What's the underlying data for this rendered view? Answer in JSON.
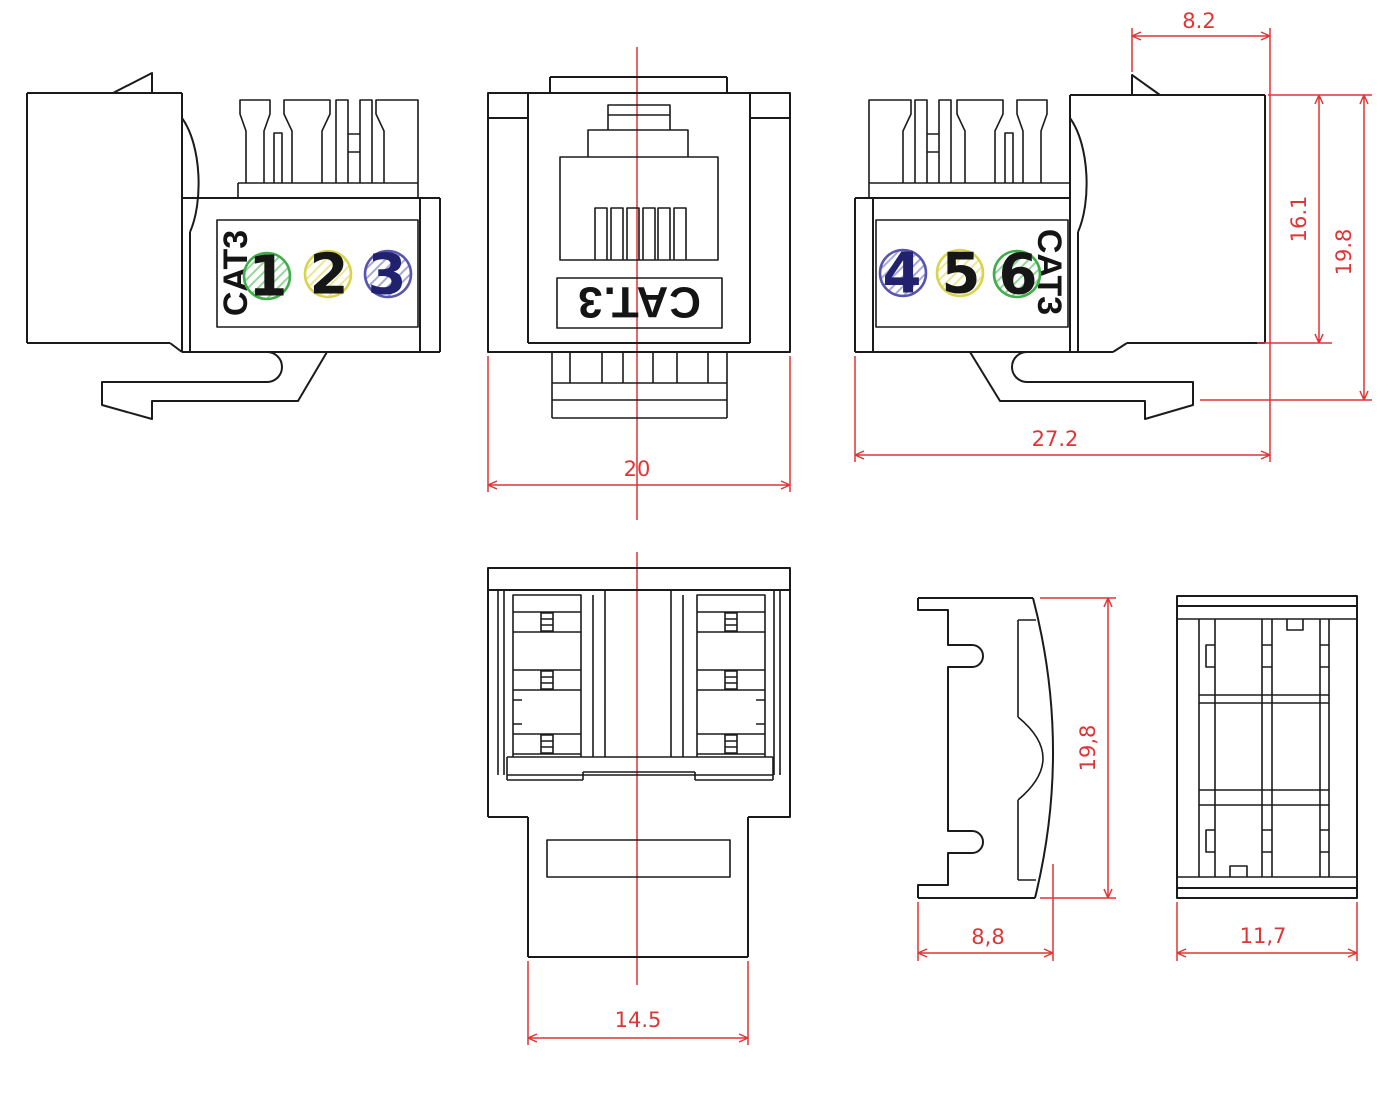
{
  "labels": {
    "side_left_marking": "CAT3",
    "front_marking": "CAT.3",
    "side_right_marking": "CAT3"
  },
  "ports_left": [
    {
      "number": "1",
      "circle_color": "#3fae49",
      "number_color": "#161616"
    },
    {
      "number": "2",
      "circle_color": "#d8d44e",
      "number_color": "#161616"
    },
    {
      "number": "3",
      "circle_color": "#5656b0",
      "number_color": "#21216e"
    }
  ],
  "ports_right": [
    {
      "number": "4",
      "circle_color": "#5656b0",
      "number_color": "#21216e"
    },
    {
      "number": "5",
      "circle_color": "#d8d44e",
      "number_color": "#161616"
    },
    {
      "number": "6",
      "circle_color": "#3fae49",
      "number_color": "#161616"
    }
  ],
  "dimensions": {
    "front_width": "20",
    "nose_depth": "8.2",
    "body_height": "16.1",
    "overall_height": "19.8",
    "overall_depth": "27.2",
    "stem_width": "14.5",
    "profile_height": "19,8",
    "profile_depth": "8,8",
    "rear_width": "11,7"
  },
  "colors": {
    "line": "#1b1b1b",
    "dimension": "#de3537",
    "hatch_green": "#95d79a",
    "hatch_yellow": "#ece798",
    "hatch_blue": "#a8a8da"
  }
}
